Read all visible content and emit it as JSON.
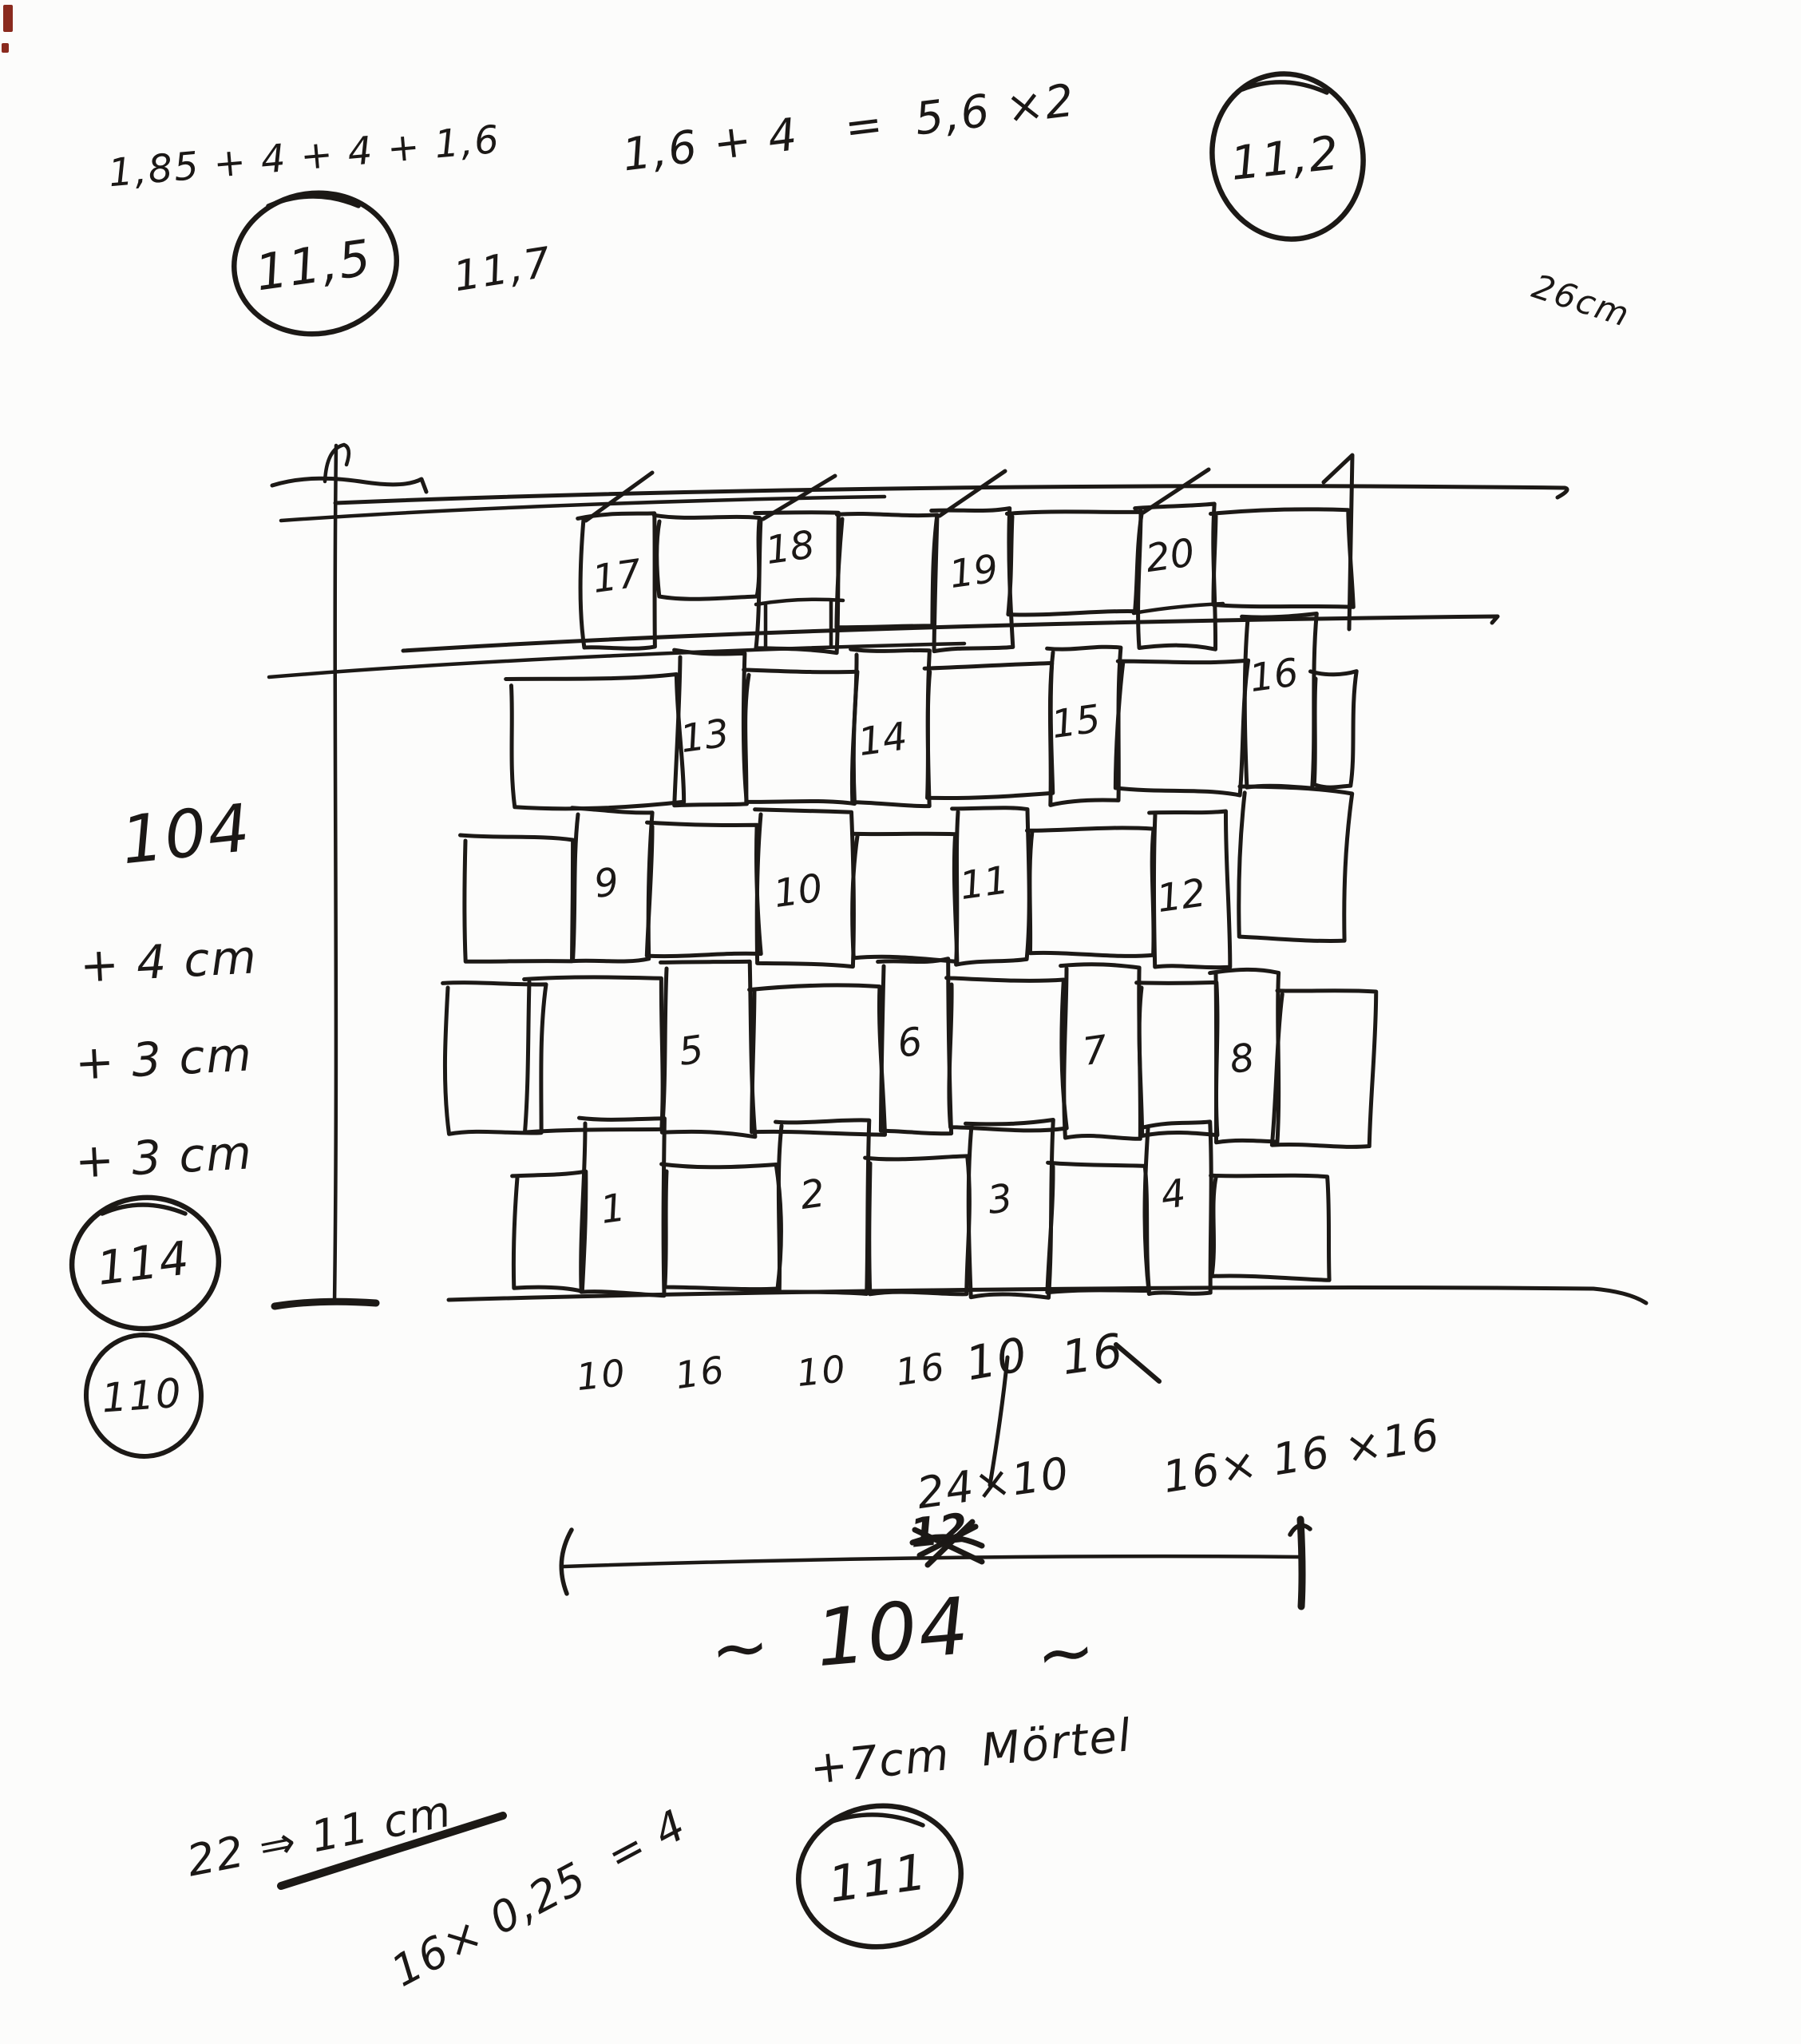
{
  "sketch": {
    "top": {
      "calc_left": "1,85 + 4 + 4 + 1,6",
      "circled_left": "11,5",
      "note_117": "11,7",
      "calc_mid": "1,6 + 4   =  5,6 ×2",
      "circled_right": "11,2",
      "note_26cm": "26cm"
    },
    "left": {
      "width_104": "104",
      "plus_4cm": "+ 4 cm",
      "plus_3cm_a": "+ 3 cm",
      "plus_3cm_b": "+ 3 cm",
      "circled_114": "114",
      "circled_110": "110"
    },
    "wall": {
      "brick_labels": [
        "1",
        "2",
        "3",
        "4",
        "5",
        "6",
        "7",
        "8",
        "9",
        "10",
        "11",
        "12",
        "13",
        "14",
        "15",
        "16",
        "17",
        "18",
        "19",
        "20"
      ]
    },
    "bottom": {
      "widths": [
        "10",
        "16",
        "10",
        "16",
        "10",
        "16"
      ],
      "size_24x10": "24×10",
      "crossed_12": "12",
      "size_16cube": "16× 16 ×16",
      "tilde_left": "~",
      "dim_104": "104",
      "tilde_right": "~",
      "mortar_note": "+7cm  Mörtel",
      "circled_111": "111",
      "calc_22": "22 ⇒ 11 cm",
      "calc_1625": "16× 0,25  = 4"
    }
  }
}
